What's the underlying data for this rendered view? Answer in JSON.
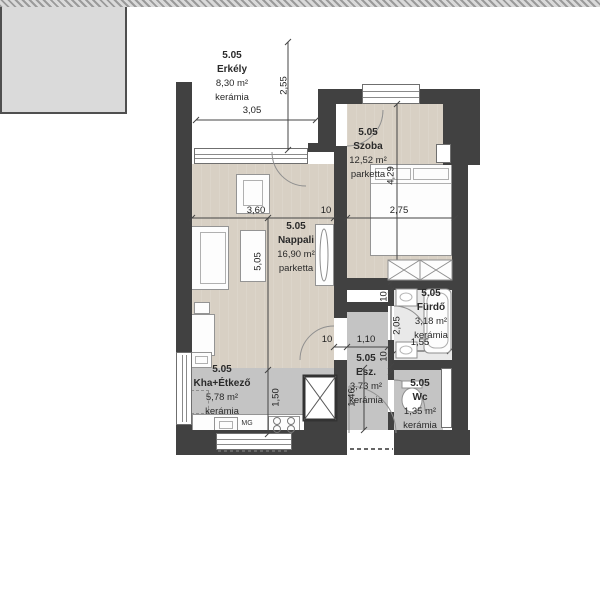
{
  "plan": {
    "title": "Lakás 5.05 alaprajz",
    "rooms": [
      {
        "id": "5.05",
        "name": "Erkély",
        "area": "8,30 m²",
        "floor": "kerámia"
      },
      {
        "id": "5.05",
        "name": "Szoba",
        "area": "12,52 m²",
        "floor": "parketta"
      },
      {
        "id": "5.05",
        "name": "Nappali",
        "area": "16,90 m²",
        "floor": "parketta"
      },
      {
        "id": "5.05",
        "name": "Kha+Étkező",
        "area": "5,78 m²",
        "floor": "kerámia"
      },
      {
        "id": "5.05",
        "name": "Esz.",
        "area": "3,73 m²",
        "floor": "kerámia"
      },
      {
        "id": "5.05",
        "name": "Fürdő",
        "area": "3,18 m²",
        "floor": "kerámia"
      },
      {
        "id": "5.05",
        "name": "Wc",
        "area": "1,35 m²",
        "floor": "kerámia"
      }
    ],
    "dimensions": {
      "balcony_width": "3,05",
      "balcony_depth": "2,55",
      "nappali_width": "3,60",
      "wall_a": "10",
      "szoba_width": "2,75",
      "szoba_depth": "4,29",
      "nappali_depth": "5,05",
      "kitchen_depth": "1,50",
      "esz_wall": "10",
      "esz_width": "1,10",
      "furdo_wall_top": "10",
      "furdo_depth": "2,05",
      "furdo_wall_bottom": "10",
      "furdo_width": "1,55",
      "wc_depth": "1,46"
    },
    "appliances": {
      "mg": "MG"
    },
    "colors": {
      "wall": "#414141",
      "parketta": "#d8d0c4",
      "ceramic": "#c4c4c4",
      "balcony": "#dadada",
      "bath": "#e9e9e9"
    }
  }
}
